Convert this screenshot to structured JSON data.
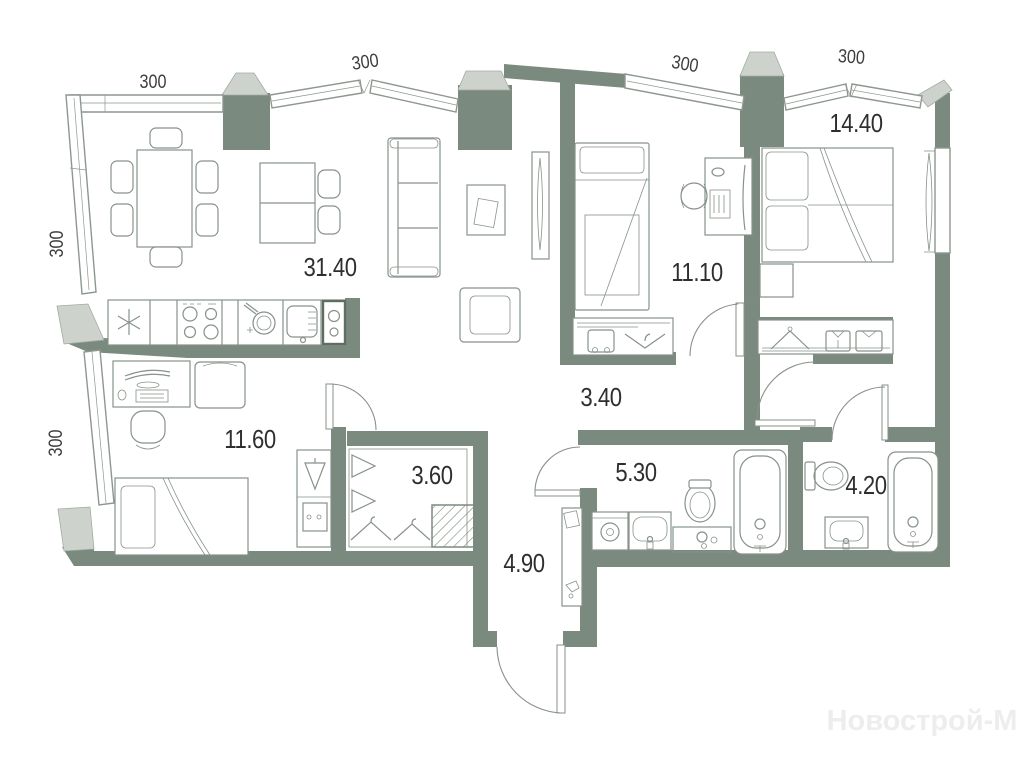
{
  "floor_plan": {
    "watermark": "Новострой-М",
    "rooms": [
      {
        "name": "living-room-kitchen",
        "area": "31.40"
      },
      {
        "name": "bedroom-1",
        "area": "11.10"
      },
      {
        "name": "bedroom-2",
        "area": "14.40"
      },
      {
        "name": "corridor",
        "area": "3.40"
      },
      {
        "name": "bedroom-3",
        "area": "11.60"
      },
      {
        "name": "wardrobe",
        "area": "3.60"
      },
      {
        "name": "entry-hall",
        "area": "4.90"
      },
      {
        "name": "bathroom-1",
        "area": "5.30"
      },
      {
        "name": "bathroom-2",
        "area": "4.20"
      }
    ],
    "dimensions": [
      {
        "name": "top-left-window",
        "value": "300"
      },
      {
        "name": "top-bay-window",
        "value": "300"
      },
      {
        "name": "bedroom-1-window",
        "value": "300"
      },
      {
        "name": "bedroom-2-window",
        "value": "300"
      },
      {
        "name": "left-upper-window",
        "value": "300"
      },
      {
        "name": "left-lower-window",
        "value": "300"
      }
    ],
    "colors": {
      "wall": "#7b8a7e",
      "cap": "#cdd2cd",
      "line": "#87928a",
      "label": "#2e2e2e",
      "watermark": "#ededed"
    }
  }
}
